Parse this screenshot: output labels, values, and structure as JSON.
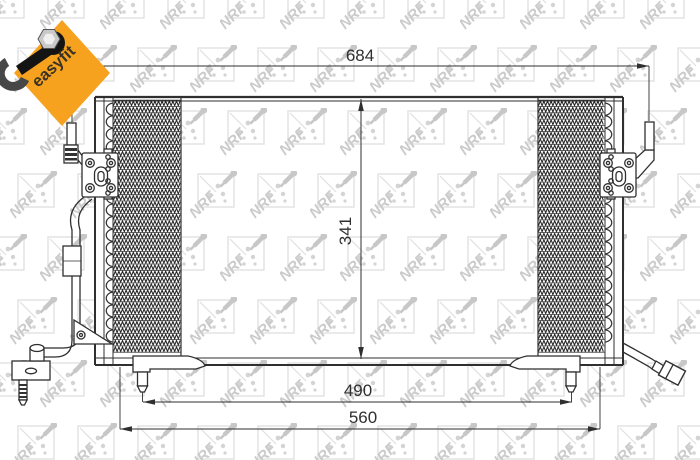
{
  "badge": {
    "label": "easyfit",
    "background_color": "#F6A21F",
    "text_color": "#3a3325"
  },
  "watermark": {
    "brand": "NRF",
    "color": "#cbcbcb",
    "box_color": "#e0e0e0",
    "dot_color": "#d4d4d4",
    "tool_color": "#c7c7c7"
  },
  "dimensions": {
    "overall_width": "684",
    "core_height": "341",
    "pin_span": "490",
    "mount_span": "560"
  },
  "drawing": {
    "line_color": "#2f2f2f",
    "fin_color": "#262626",
    "text_color": "#2f2f2f"
  }
}
